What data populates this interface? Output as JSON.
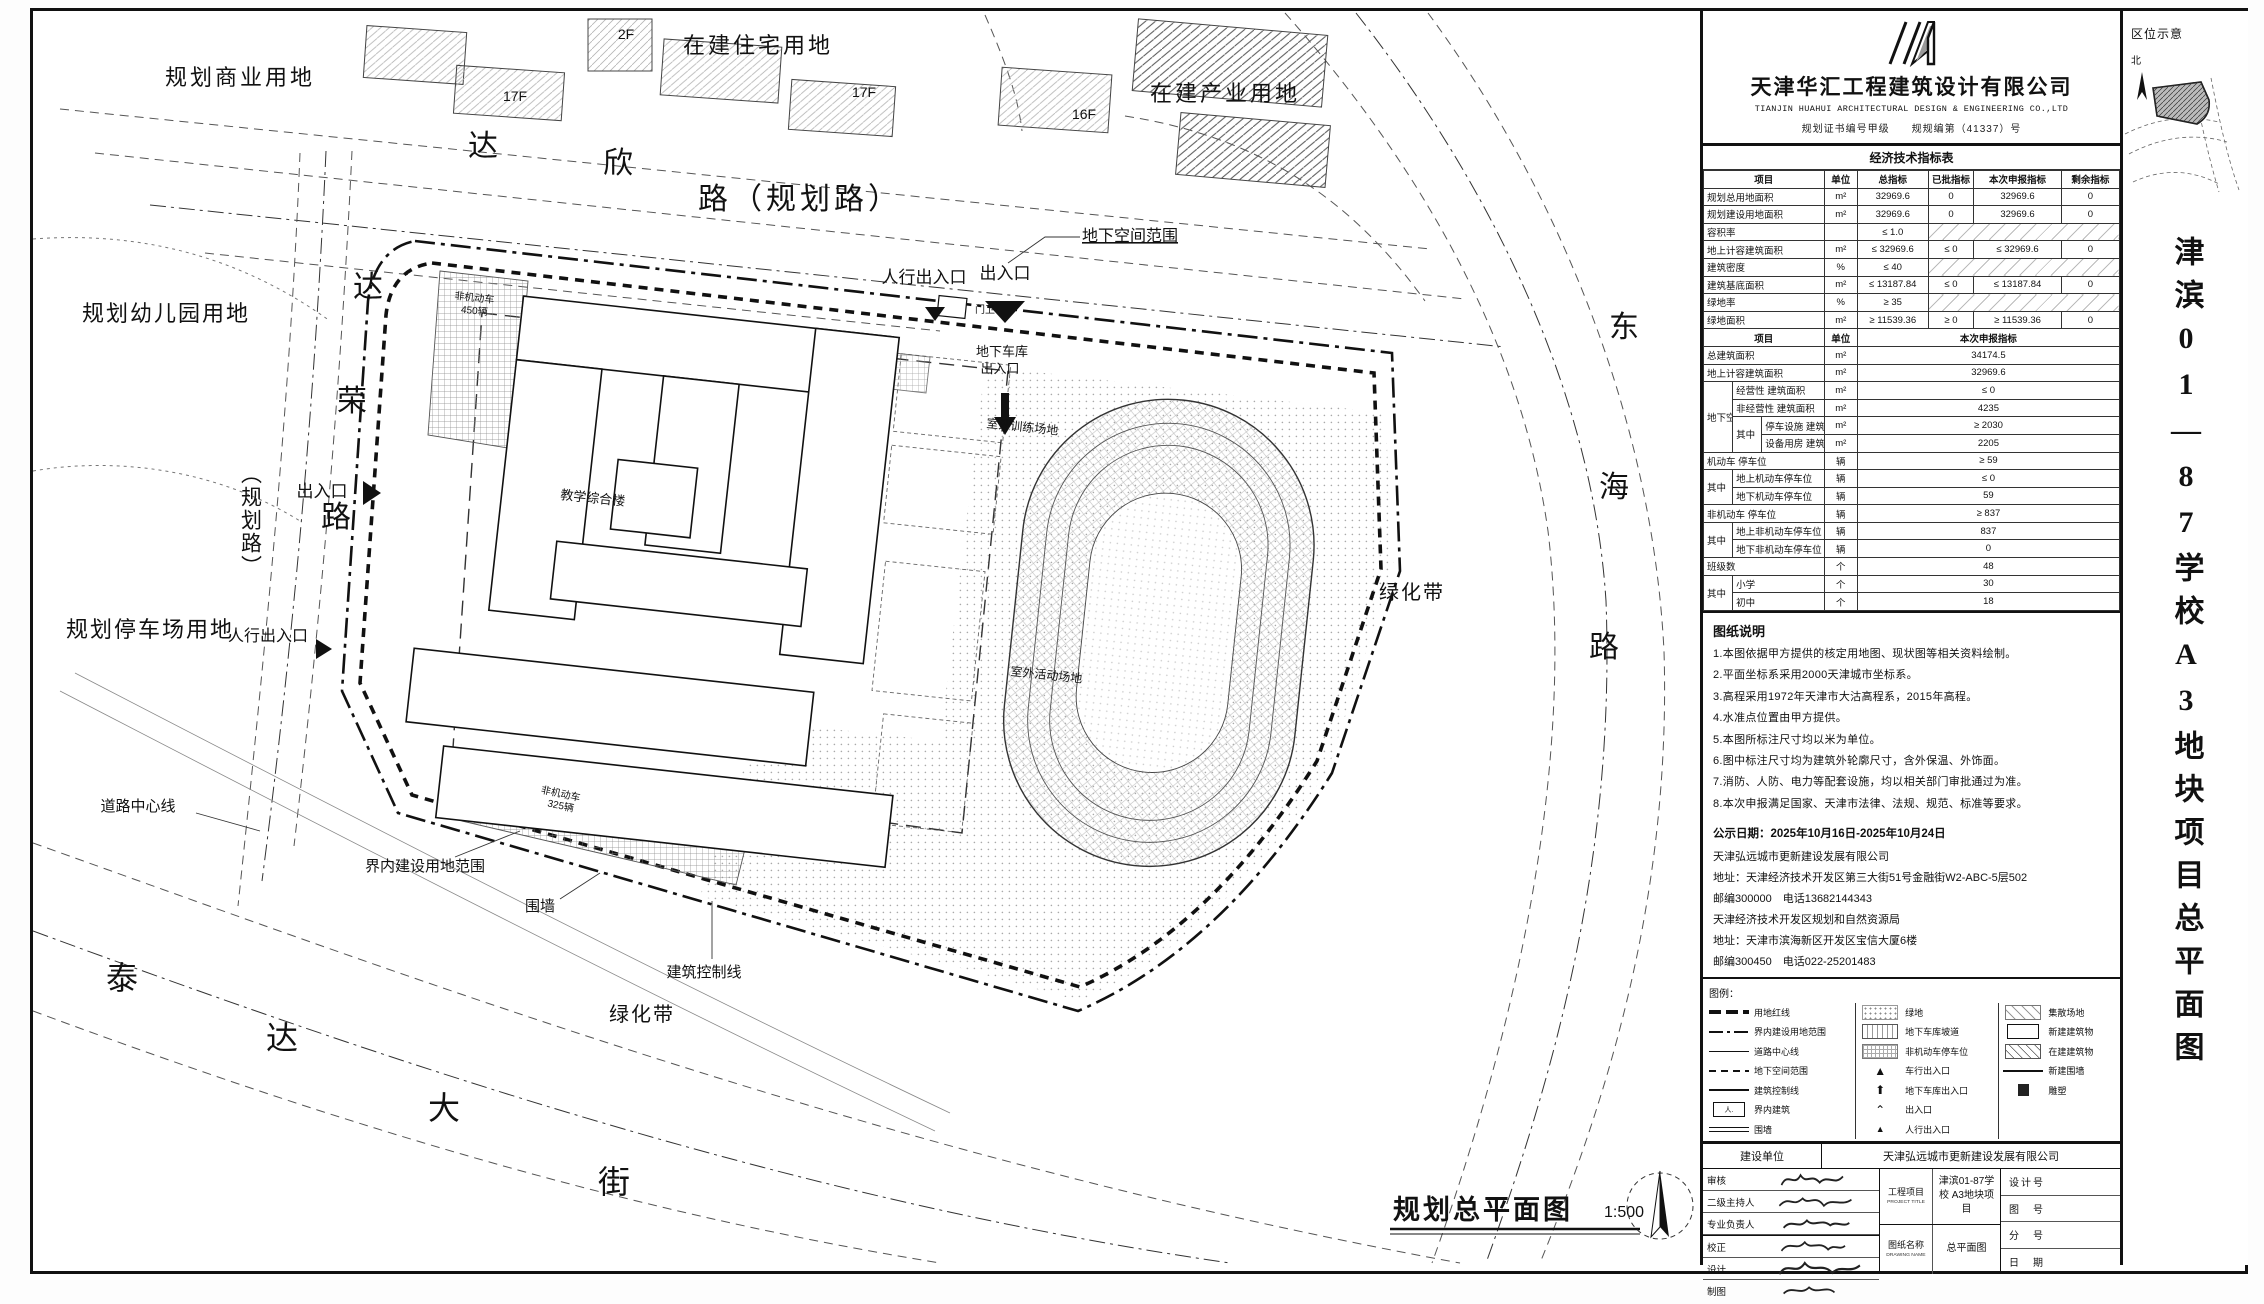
{
  "plan": {
    "parcels": {
      "commercial": "规划商业用地",
      "residential": "在建住宅用地",
      "industrial": "在建产业用地",
      "kindergarten": "规划幼儿园用地",
      "parking": "规划停车场用地"
    },
    "roads": {
      "daxin": [
        "达",
        "欣",
        "路（规划路）"
      ],
      "darong": [
        "达",
        "荣",
        "路"
      ],
      "darong_suffix": "（规划路）",
      "taida": [
        "泰",
        "达",
        "大",
        "街"
      ],
      "donghai": [
        "东",
        "海",
        "路"
      ]
    },
    "labels": {
      "road_center": "道路中心线",
      "green_belt_e": "绿化带",
      "green_belt_s": "绿化带",
      "underground": "地下空间范围",
      "ped_entrance_n": "人行出入口",
      "entrance_n": "出入口",
      "garage_l1": "地下车库",
      "garage_l2": "出入口",
      "entrance_w": "出入口",
      "ped_entrance_w": "人行出入口",
      "site_boundary": "界内建设用地范围",
      "wall": "围墙",
      "control_line": "建筑控制线",
      "main_building": "教学综合楼",
      "bike_n1": "非机动车",
      "bike_n2": "450辆",
      "bike_s1": "非机动车",
      "bike_s2": "325辆",
      "sports_w": "室外训练场地",
      "sports_s": "室外活动场地",
      "gate": "门卫",
      "floors": [
        "17F",
        "2F",
        "17F",
        "16F"
      ]
    },
    "caption": {
      "title": "规划总平面图",
      "scale": "1:500"
    }
  },
  "panel": {
    "company": {
      "name_cn": "天津华汇工程建筑设计有限公司",
      "name_en": "TIANJIN HUAHUI ARCHITECTURAL DESIGN & ENGINEERING CO.,LTD",
      "cert": "规划证书编号甲级　　规规编第（41337）号"
    },
    "econ_title": "经济技术指标表",
    "econ_rows": [
      [
        {
          "t": "项目",
          "c": 3,
          "k": "hd"
        },
        {
          "t": "单位",
          "k": "hd"
        },
        {
          "t": "总指标",
          "k": "hd"
        },
        {
          "t": "已批指标",
          "k": "hd"
        },
        {
          "t": "本次申报指标",
          "k": "hd"
        },
        {
          "t": "剩余指标",
          "k": "hd"
        }
      ],
      [
        {
          "t": "规划总用地面积",
          "c": 3,
          "k": "nm"
        },
        {
          "t": "m²"
        },
        {
          "t": "32969.6"
        },
        {
          "t": "0"
        },
        {
          "t": "32969.6"
        },
        {
          "t": "0"
        }
      ],
      [
        {
          "t": "规划建设用地面积",
          "c": 3,
          "k": "nm"
        },
        {
          "t": "m²"
        },
        {
          "t": "32969.6"
        },
        {
          "t": "0"
        },
        {
          "t": "32969.6"
        },
        {
          "t": "0"
        }
      ],
      [
        {
          "t": "容积率",
          "c": 3,
          "k": "nm"
        },
        {
          "t": ""
        },
        {
          "t": "≤ 1.0"
        },
        {
          "t": "",
          "c": 3,
          "k": "na"
        }
      ],
      [
        {
          "t": "地上计容建筑面积",
          "c": 3,
          "k": "nm"
        },
        {
          "t": "m²"
        },
        {
          "t": "≤ 32969.6"
        },
        {
          "t": "≤ 0"
        },
        {
          "t": "≤ 32969.6"
        },
        {
          "t": "0"
        }
      ],
      [
        {
          "t": "建筑密度",
          "c": 3,
          "k": "nm"
        },
        {
          "t": "%"
        },
        {
          "t": "≤ 40"
        },
        {
          "t": "",
          "c": 3,
          "k": "na"
        }
      ],
      [
        {
          "t": "建筑基底面积",
          "c": 3,
          "k": "nm"
        },
        {
          "t": "m²"
        },
        {
          "t": "≤ 13187.84"
        },
        {
          "t": "≤ 0"
        },
        {
          "t": "≤ 13187.84"
        },
        {
          "t": "0"
        }
      ],
      [
        {
          "t": "绿地率",
          "c": 3,
          "k": "nm"
        },
        {
          "t": "%"
        },
        {
          "t": "≥ 35"
        },
        {
          "t": "",
          "c": 3,
          "k": "na"
        }
      ],
      [
        {
          "t": "绿地面积",
          "c": 3,
          "k": "nm"
        },
        {
          "t": "m²"
        },
        {
          "t": "≥ 11539.36"
        },
        {
          "t": "≥ 0"
        },
        {
          "t": "≥ 11539.36"
        },
        {
          "t": "0"
        }
      ],
      [
        {
          "t": "项目",
          "c": 3,
          "k": "hd"
        },
        {
          "t": "单位",
          "k": "hd"
        },
        {
          "t": "本次申报指标",
          "c": 4,
          "k": "hd"
        }
      ],
      [
        {
          "t": "总建筑面积",
          "c": 3,
          "k": "nm"
        },
        {
          "t": "m²"
        },
        {
          "t": "34174.5",
          "c": 4
        }
      ],
      [
        {
          "t": "地上计容建筑面积",
          "c": 3,
          "k": "nm"
        },
        {
          "t": "m²"
        },
        {
          "t": "32969.6",
          "c": 4
        }
      ],
      [
        {
          "t": "地下空间",
          "r": 4,
          "k": "nm"
        },
        {
          "t": "经营性 建筑面积",
          "c": 2,
          "k": "nm"
        },
        {
          "t": "m²"
        },
        {
          "t": "≤ 0",
          "c": 4
        }
      ],
      [
        {
          "t": "非经营性 建筑面积",
          "c": 2,
          "k": "nm"
        },
        {
          "t": "m²"
        },
        {
          "t": "4235",
          "c": 4
        }
      ],
      [
        {
          "t": "其中",
          "r": 2,
          "k": "nm"
        },
        {
          "t": "停车设施 建筑面积",
          "k": "nm"
        },
        {
          "t": "m²"
        },
        {
          "t": "≥ 2030",
          "c": 4
        }
      ],
      [
        {
          "t": "设备用房 建筑面积",
          "k": "nm"
        },
        {
          "t": "m²"
        },
        {
          "t": "2205",
          "c": 4
        }
      ],
      [
        {
          "t": "机动车 停车位",
          "c": 3,
          "k": "nm"
        },
        {
          "t": "辆"
        },
        {
          "t": "≥ 59",
          "c": 4
        }
      ],
      [
        {
          "t": "其中",
          "r": 2,
          "k": "nm"
        },
        {
          "t": "地上机动车停车位",
          "c": 2,
          "k": "nm"
        },
        {
          "t": "辆"
        },
        {
          "t": "≤ 0",
          "c": 4
        }
      ],
      [
        {
          "t": "地下机动车停车位",
          "c": 2,
          "k": "nm"
        },
        {
          "t": "辆"
        },
        {
          "t": "59",
          "c": 4
        }
      ],
      [
        {
          "t": "非机动车 停车位",
          "c": 3,
          "k": "nm"
        },
        {
          "t": "辆"
        },
        {
          "t": "≥ 837",
          "c": 4
        }
      ],
      [
        {
          "t": "其中",
          "r": 2,
          "k": "nm"
        },
        {
          "t": "地上非机动车停车位",
          "c": 2,
          "k": "nm"
        },
        {
          "t": "辆"
        },
        {
          "t": "837",
          "c": 4
        }
      ],
      [
        {
          "t": "地下非机动车停车位",
          "c": 2,
          "k": "nm"
        },
        {
          "t": "辆"
        },
        {
          "t": "0",
          "c": 4
        }
      ],
      [
        {
          "t": "班级数",
          "c": 3,
          "k": "nm"
        },
        {
          "t": "个"
        },
        {
          "t": "48",
          "c": 4
        }
      ],
      [
        {
          "t": "其中",
          "r": 2,
          "k": "nm"
        },
        {
          "t": "小学",
          "c": 2,
          "k": "nm"
        },
        {
          "t": "个"
        },
        {
          "t": "30",
          "c": 4
        }
      ],
      [
        {
          "t": "初中",
          "c": 2,
          "k": "nm"
        },
        {
          "t": "个"
        },
        {
          "t": "18",
          "c": 4
        }
      ]
    ],
    "notes_title": "图纸说明",
    "notes": [
      "1.本图依据甲方提供的核定用地图、现状图等相关资料绘制。",
      "2.平面坐标系采用2000天津城市坐标系。",
      "3.高程采用1972年天津市大沽高程系，2015年高程。",
      "4.水准点位置由甲方提供。",
      "5.本图所标注尺寸均以米为单位。",
      "6.图中标注尺寸均为建筑外轮廓尺寸，含外保温、外饰面。",
      "7.消防、人防、电力等配套设施，均以相关部门审批通过为准。",
      "8.本次申报满足国家、天津市法律、法规、规范、标准等要求。"
    ],
    "publicity": {
      "date": "公示日期：2025年10月16日-2025年10月24日",
      "lines": [
        "天津弘远城市更新建设发展有限公司",
        "地址：天津经济技术开发区第三大街51号金融街W2-ABC-5层502",
        "邮编300000　电话13682144343",
        "天津经济技术开发区规划和自然资源局",
        "地址：天津市滨海新区开发区宝信大厦6楼",
        "邮编300450　电话022-25201483"
      ]
    },
    "legend_title": "图例：",
    "legend": {
      "col1": [
        "用地红线",
        "界内建设用地范围",
        "道路中心线",
        "地下空间范围",
        "建筑控制线",
        "界内建筑",
        "围墙"
      ],
      "col2": [
        "绿地",
        "地下车库坡道",
        "非机动车停车位",
        "车行出入口",
        "地下车库出入口",
        "出入口",
        "人行出入口"
      ],
      "col3": [
        "集散场地",
        "新建建筑物",
        "在建建筑物",
        "新建围墙",
        "雕塑"
      ]
    },
    "titleblock": {
      "owner_label": "建设单位",
      "owner": "天津弘远城市更新建设发展有限公司",
      "roles": [
        "审核",
        "二级主持人",
        "专业负责人",
        "校正",
        "设计",
        "制图"
      ],
      "project_label": "工程项目",
      "project_label_en": "PROJECT TITLE",
      "project": "津滨01-87学校 A3地块项目",
      "drawing_label": "图纸名称",
      "drawing_label_en": "DRAWING NAME",
      "drawing": "总平面图",
      "fields": [
        "设计号",
        "图　号",
        "分　号",
        "日　期"
      ]
    }
  },
  "strip": {
    "location_title": "区位示意",
    "north_label": "北",
    "vertical_title": "津滨01—87学校A3地块项目总平面图"
  }
}
